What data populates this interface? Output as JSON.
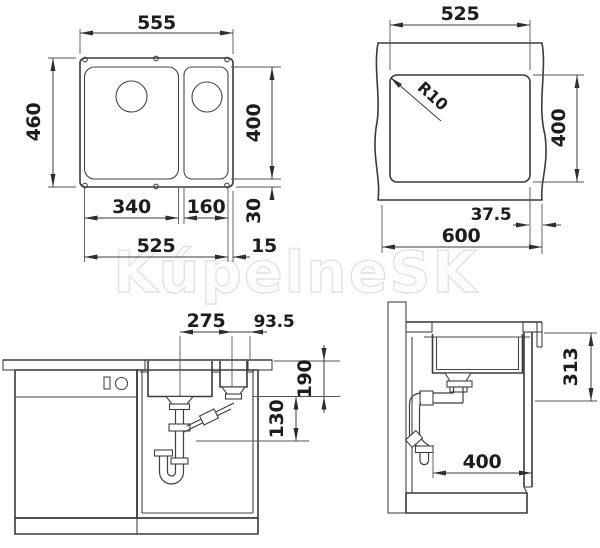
{
  "watermark": "KúpelneSK",
  "plan": {
    "overall_width": "555",
    "overall_depth": "460",
    "bowl_depth_dim": "400",
    "main_bowl_width": "340",
    "small_bowl_width": "160",
    "bowls_total_width": "525",
    "rear_rim": "30",
    "side_rim": "15"
  },
  "cutout": {
    "width": "525",
    "depth": "400",
    "corner_radius": "R10",
    "edge_offset": "37.5",
    "worktop_width": "600"
  },
  "front": {
    "drain_distance": "275",
    "drain_to_edge": "93.5",
    "bowl_depth": "190",
    "trap_drop": "130"
  },
  "side": {
    "install_depth": "313",
    "bowl_length": "400"
  }
}
